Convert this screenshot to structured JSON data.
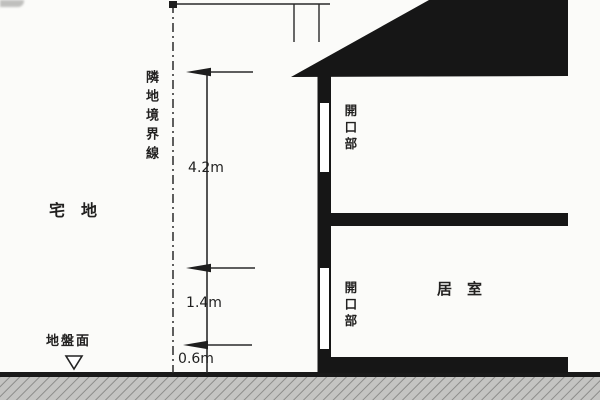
{
  "diagram": {
    "type": "architectural-section",
    "labels": {
      "boundary_line": "隣地境界線",
      "site": "宅　地",
      "ground_surface": "地盤面",
      "opening_upper": "開口部",
      "opening_lower": "開口部",
      "room": "居　室"
    },
    "dimensions": {
      "top": "4.2m",
      "middle": "1.4m",
      "bottom": "0.6m"
    },
    "markers": {
      "ground_level_symbol": "triangle-down-outline"
    },
    "colors": {
      "ink": "#1e1e1e",
      "paper": "#fbfbf9",
      "earth_fill": "#c4c4c2",
      "earth_hatch": "#8d8d8b"
    }
  }
}
